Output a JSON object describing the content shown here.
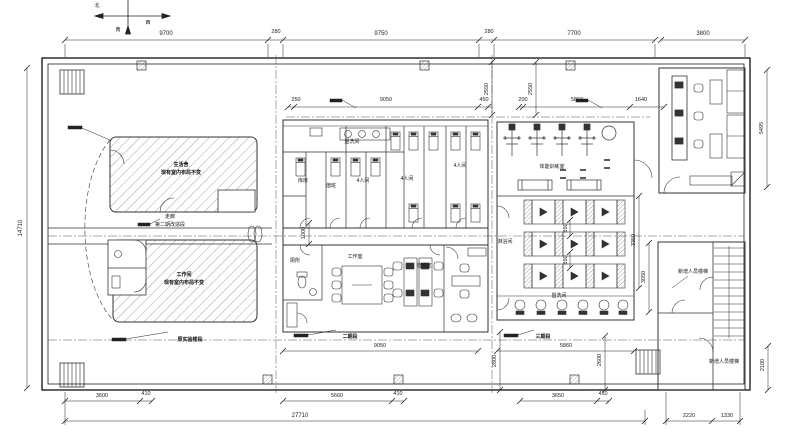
{
  "compass": {
    "n": "北",
    "w": "西",
    "s": "南"
  },
  "dims": {
    "top": [
      "9700",
      "280",
      "9750",
      "280",
      "7700",
      "3800"
    ],
    "row2": [
      "250",
      "9050",
      "450",
      "200",
      "5860",
      "1640"
    ],
    "v2550a": "2550",
    "v2550b": "2550",
    "corridor_w": "1000",
    "left_total": "14710",
    "right_top": "5495",
    "shower_h": "3350",
    "stair_h": "3050",
    "below_mid": "9050",
    "below_right": "5860",
    "b2800": "2800",
    "b2600": "2600",
    "b2100": "2100",
    "aisle_a": "850",
    "aisle_b": "850",
    "bottom": [
      "3600",
      "410",
      "5660",
      "410",
      "3650",
      "410"
    ],
    "total": "27710",
    "r1": "2220",
    "r2": "1330"
  },
  "rooms": {
    "upper_left_1": "生活舍",
    "upper_left_2": "现有室内布局不变",
    "lower_left_1": "工作间",
    "lower_left_2": "现有室内布局不变",
    "corridor_1": "走廊",
    "corridor_2": "第二期改造段",
    "phase_left": "原实验楼段",
    "phase_mid": "二期段",
    "phase_right": "三期段",
    "wash_top": "盥洗间",
    "storage": "库房",
    "duty": "值班",
    "dorm_a": "4人间",
    "dorm_b": "4人间",
    "dorm_c": "4人间",
    "wc": "厕所",
    "workroom": "工作室",
    "duty_office": "值班室",
    "gym": "体能训练室",
    "shower": "淋浴间",
    "wash_bottom": "盥洗间",
    "stair_top": "新增人员楼梯",
    "stair_bottom": "新增人员楼梯"
  }
}
